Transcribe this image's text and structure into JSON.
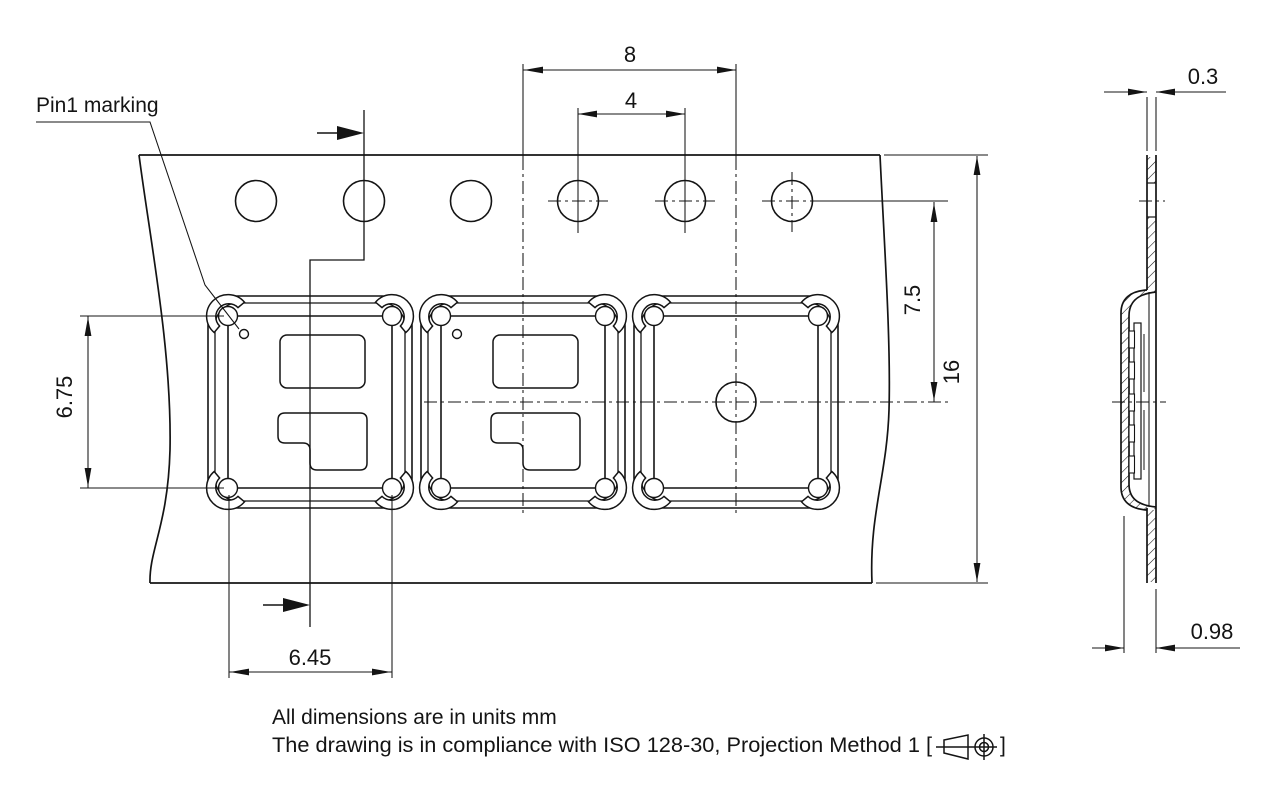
{
  "drawing": {
    "labels": {
      "pin1_marking": "Pin1 marking"
    },
    "dimensions": {
      "pocket_pitch": "8",
      "sprocket_hole_pitch": "4",
      "hole_to_pocket_center": "7.5",
      "tape_width": "16",
      "component_height": "6.75",
      "component_width": "6.45",
      "tape_thickness": "0.3",
      "pocket_depth": "0.98"
    },
    "notes": {
      "units_note": "All dimensions are in units mm",
      "compliance_prefix": "The drawing is in compliance with ISO 128-30, Projection Method 1 [",
      "compliance_suffix": "]"
    },
    "colors": {
      "line": "#141414",
      "background": "#ffffff"
    }
  }
}
